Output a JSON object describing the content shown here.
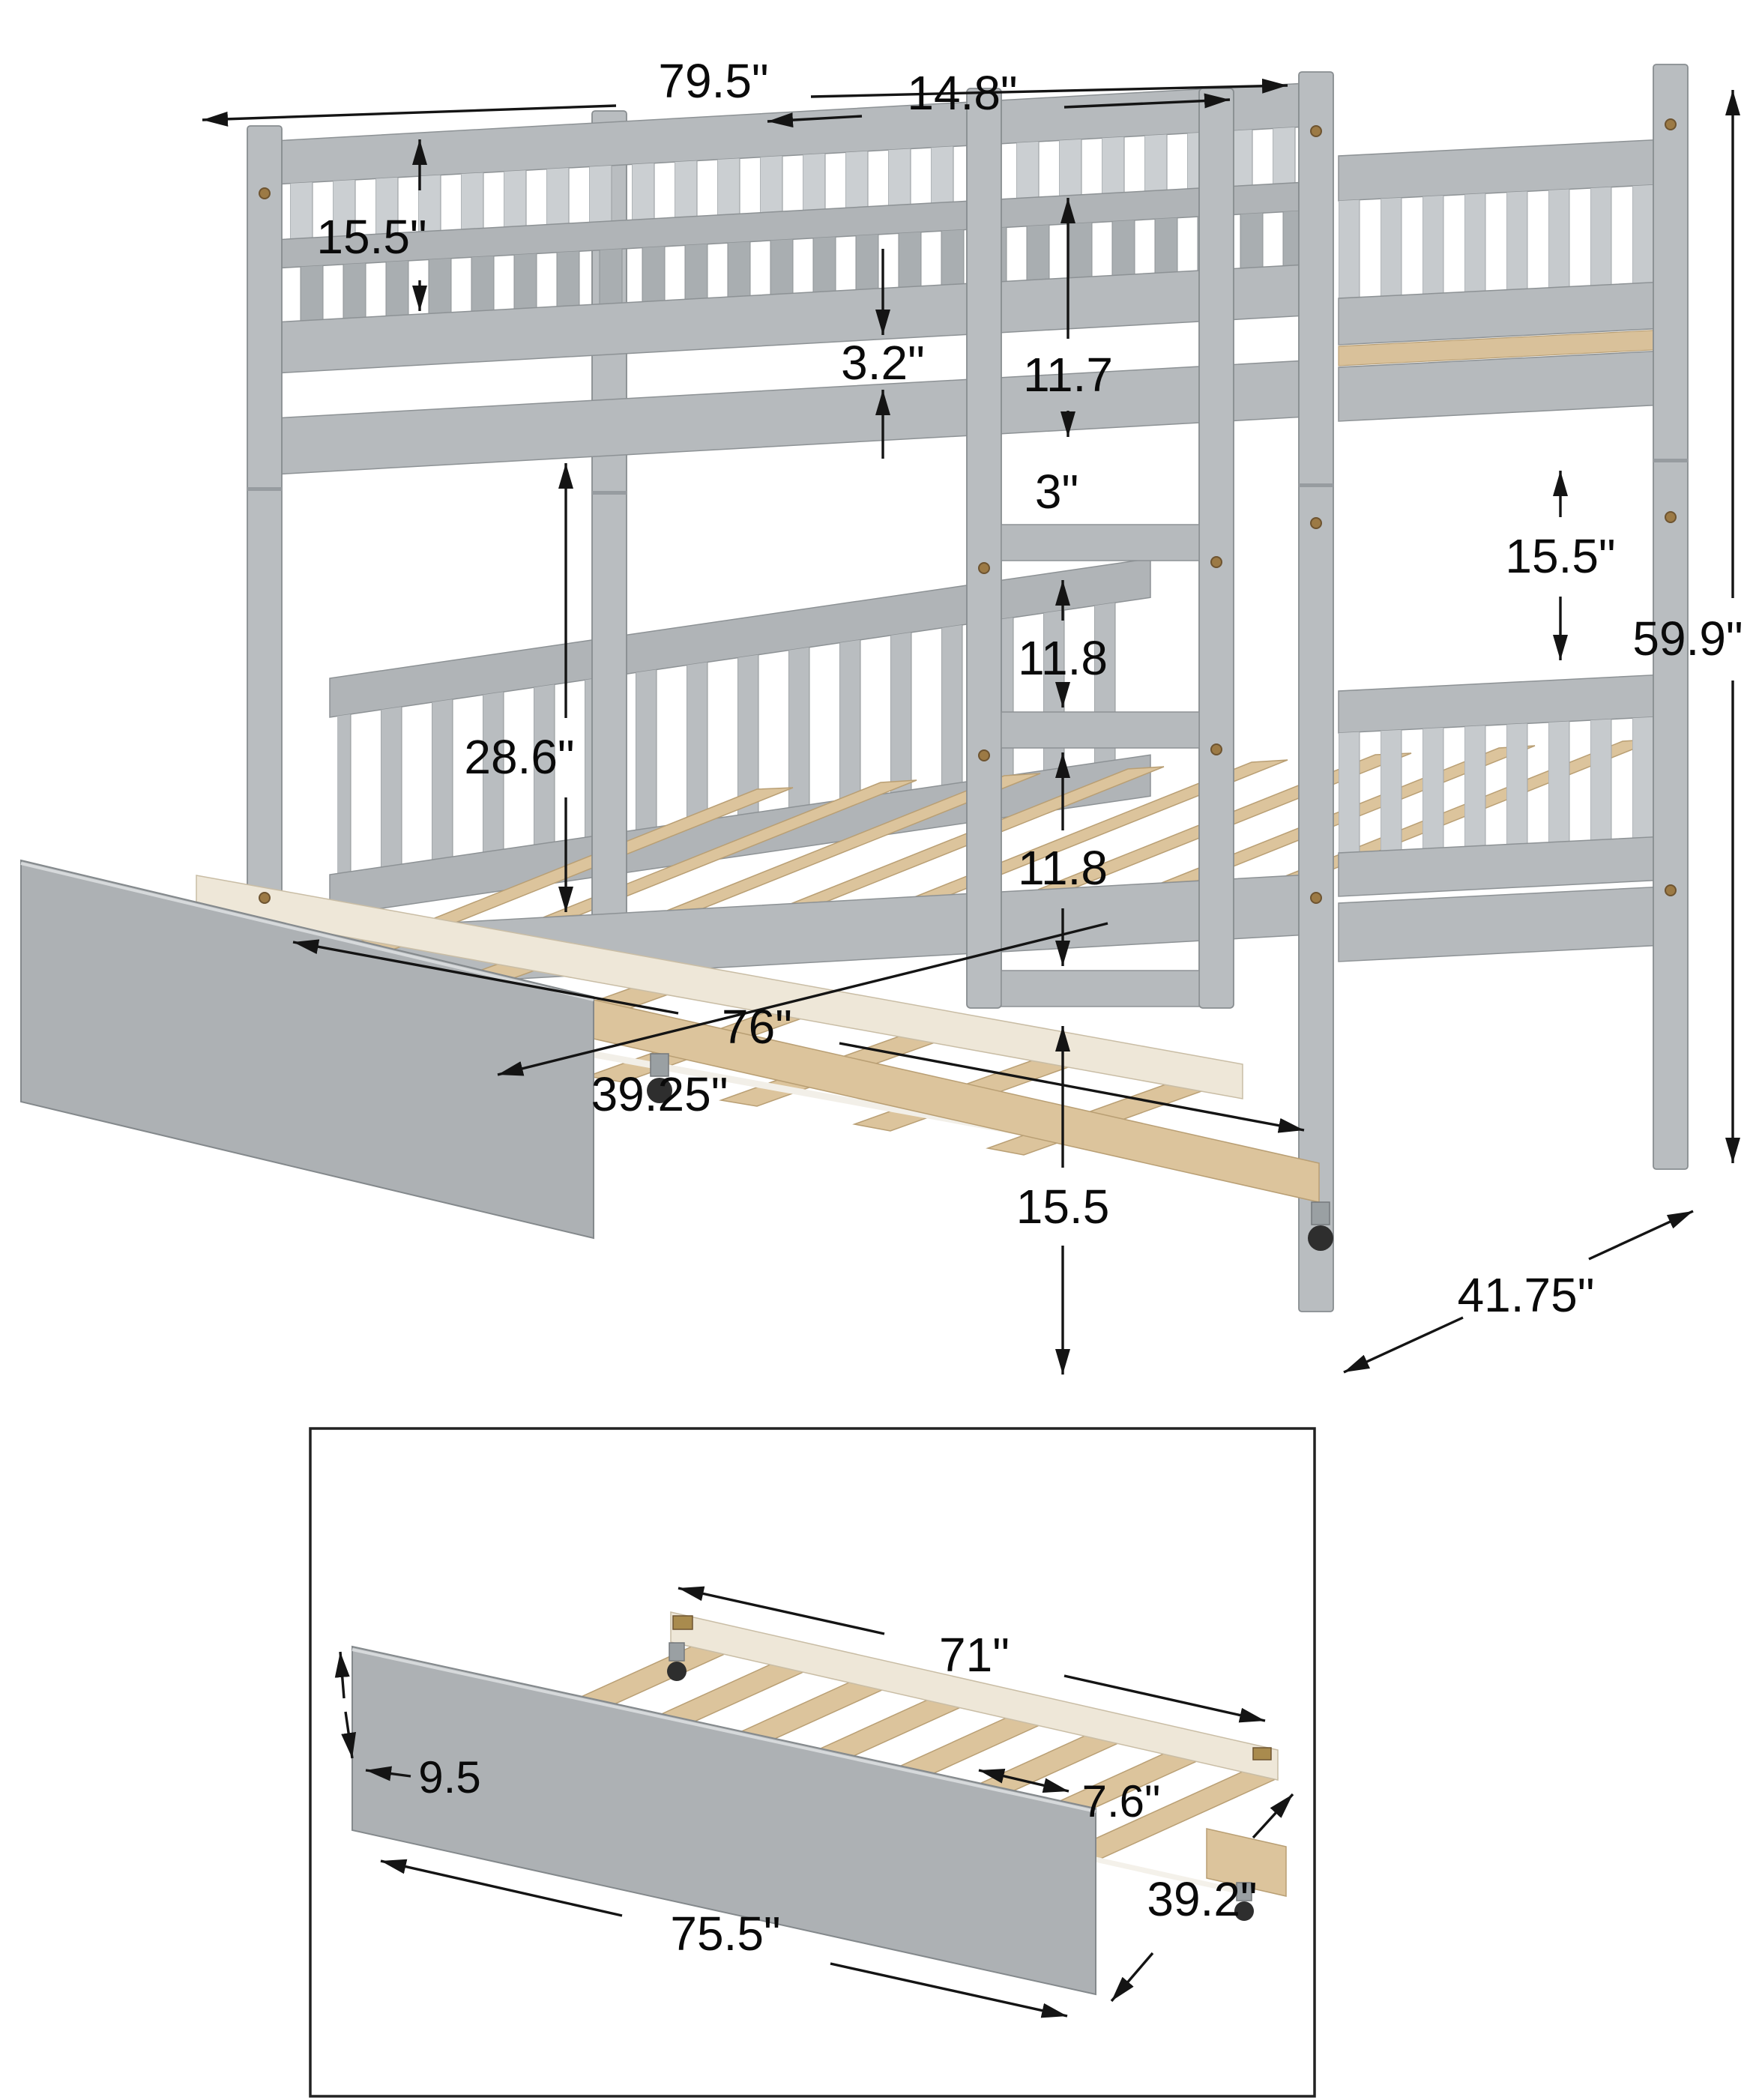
{
  "main": {
    "dims": {
      "overall_length": "79.5\"",
      "guard_rail_height": "15.5\"",
      "rail_gap": "3.2\"",
      "ladder_width": "14.8\"",
      "rail_to_frame": "11.7",
      "frame_to_rung": "3\"",
      "rung_gap_upper": "11.8",
      "rung_gap_lower": "11.8",
      "bunk_gap": "28.6\"",
      "bed_inner_width": "39.25\"",
      "trundle_extended_length": "76\"",
      "under_bed_clearance": "15.5",
      "overall_height": "59.9\"",
      "lower_panel_height": "15.5\"",
      "overall_depth": "41.75\""
    }
  },
  "inset": {
    "dims": {
      "slat_frame_length": "71\"",
      "panel_height": "9.5",
      "slat_spacing": "7.6\"",
      "trundle_length": "75.5\"",
      "trundle_width": "39.2\""
    }
  },
  "colors": {
    "bed_gray": "#b6babd",
    "panel_gray": "#adb1b4",
    "wood": "#dcc49c",
    "wood_cream": "#eee7d8",
    "dimension_line": "#141414",
    "background": "#ffffff"
  }
}
